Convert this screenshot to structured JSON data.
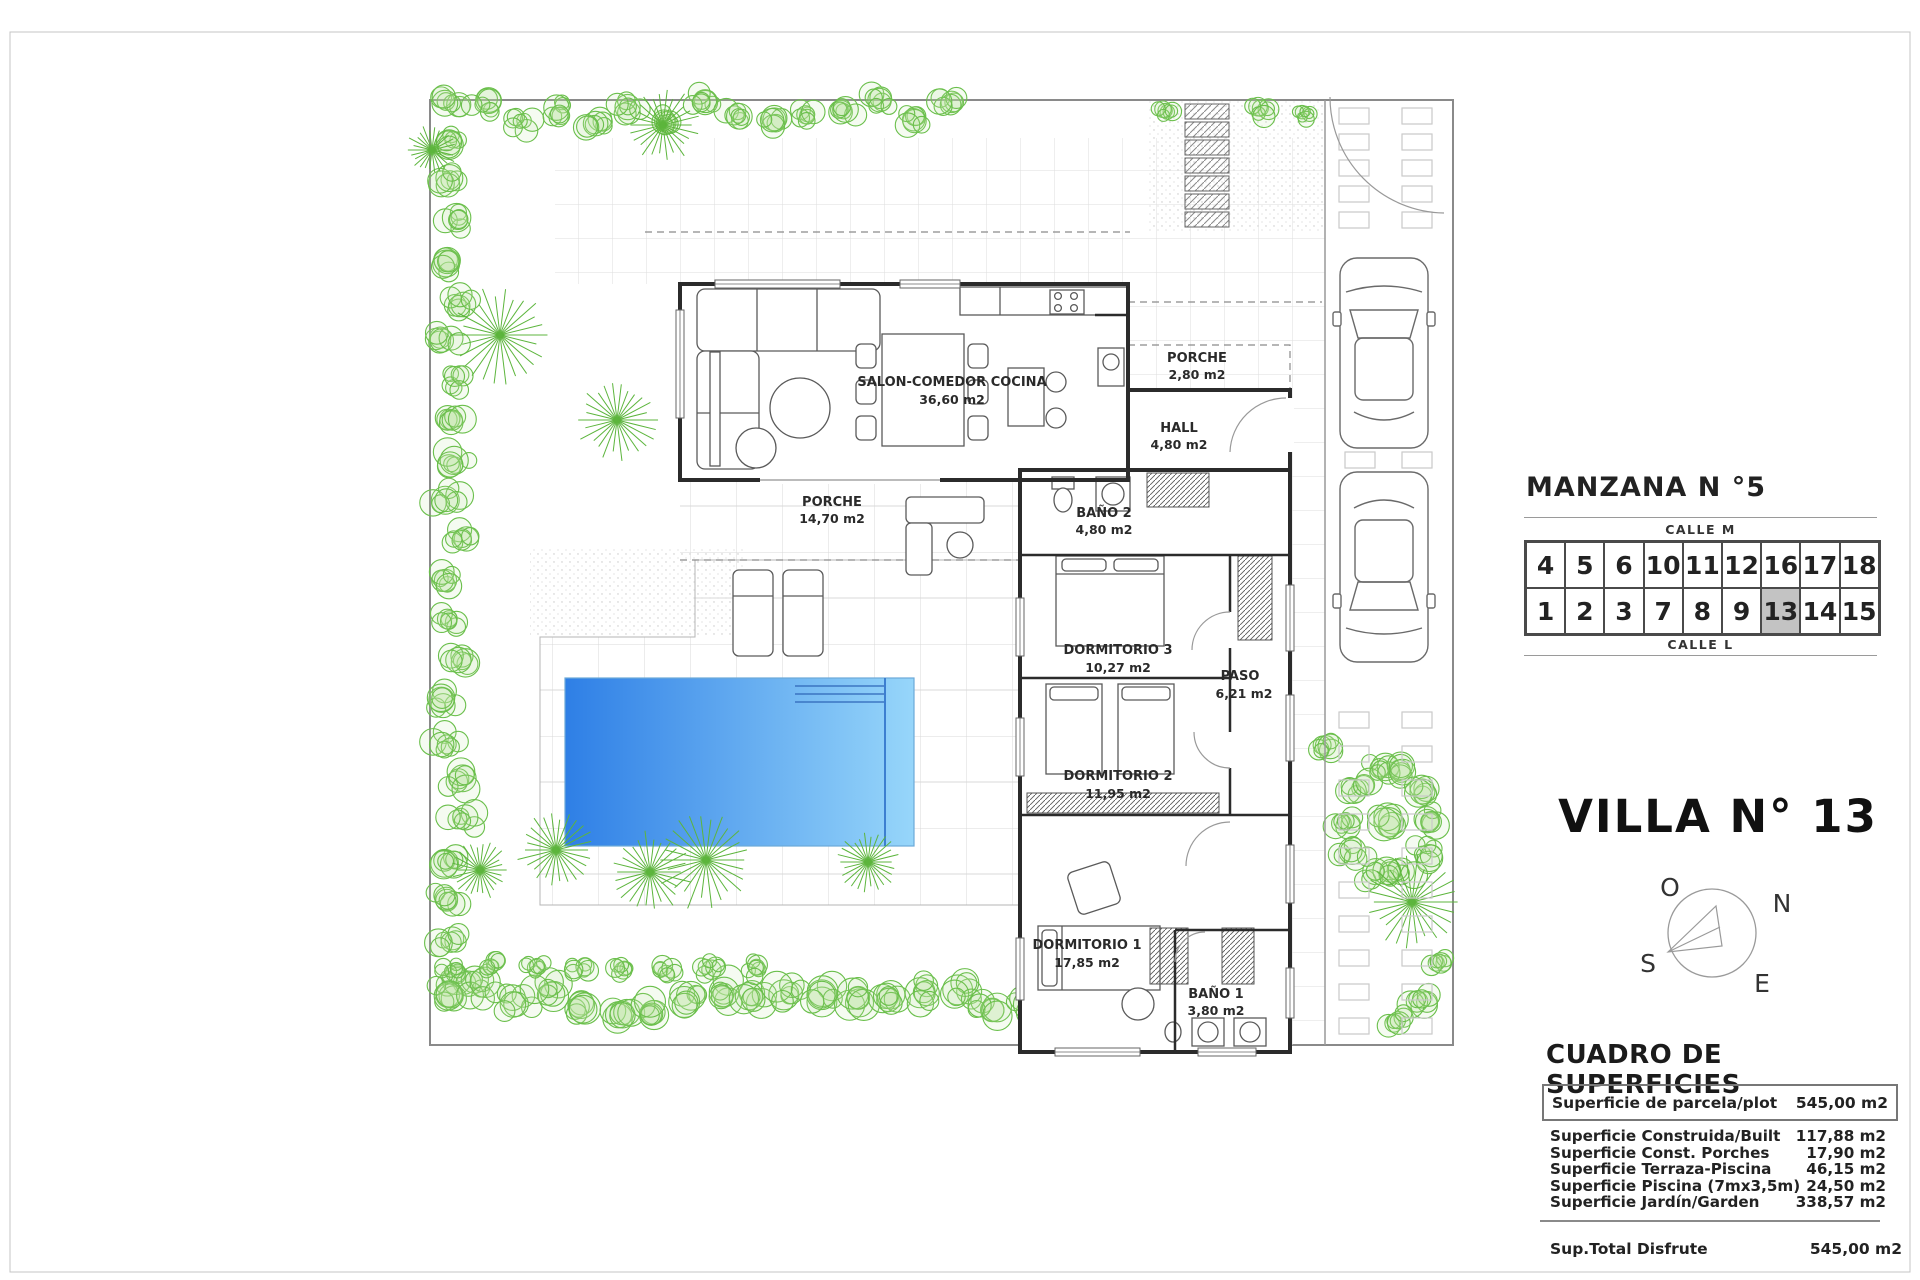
{
  "plan": {
    "rooms": [
      {
        "name": "SALON-COMEDOR COCINA",
        "area": "36,60 m2"
      },
      {
        "name": "PORCHE",
        "area": "2,80 m2"
      },
      {
        "name": "HALL",
        "area": "4,80 m2"
      },
      {
        "name": "PORCHE",
        "area": "14,70 m2"
      },
      {
        "name": "BAÑO 2",
        "area": "4,80 m2"
      },
      {
        "name": "DORMITORIO 3",
        "area": "10,27 m2"
      },
      {
        "name": "PASO",
        "area": "6,21 m2"
      },
      {
        "name": "DORMITORIO 2",
        "area": "11,95 m2"
      },
      {
        "name": "DORMITORIO 1",
        "area": "17,85 m2"
      },
      {
        "name": "BAÑO 1",
        "area": "3,80 m2"
      }
    ]
  },
  "colors": {
    "pool_left": "#2e7fe6",
    "pool_right": "#97d6fa",
    "vegetation": "#6abf4b",
    "wall": "#2b2b2b",
    "highlight_cell": "#c3c3c3"
  },
  "manzana": {
    "title": "MANZANA N °5",
    "street_top": "CALLE M",
    "street_bottom": "CALLE L",
    "row_top": [
      "4",
      "5",
      "6",
      "10",
      "11",
      "12",
      "16",
      "17",
      "18"
    ],
    "row_bottom": [
      "1",
      "2",
      "3",
      "7",
      "8",
      "9",
      "13",
      "14",
      "15"
    ],
    "highlighted": "13"
  },
  "villa": {
    "title": "VILLA N° 13"
  },
  "compass": {
    "o": "O",
    "n": "N",
    "s": "S",
    "e": "E"
  },
  "superficies": {
    "title": "CUADRO DE SUPERFICIES",
    "parcela": {
      "label": "Superficie de parcela/plot",
      "value": "545,00 m2"
    },
    "rows": [
      {
        "label": "Superficie Construida/Built",
        "value": "117,88 m2"
      },
      {
        "label": "Superficie Const. Porches",
        "value": "17,90 m2"
      },
      {
        "label": "Superficie Terraza-Piscina",
        "value": "46,15 m2"
      },
      {
        "label": "Superficie Piscina (7mx3,5m)",
        "value": "24,50 m2"
      },
      {
        "label": "Superficie Jardín/Garden",
        "value": "338,57 m2"
      }
    ],
    "total": {
      "label": "Sup.Total Disfrute",
      "value": "545,00 m2"
    }
  }
}
